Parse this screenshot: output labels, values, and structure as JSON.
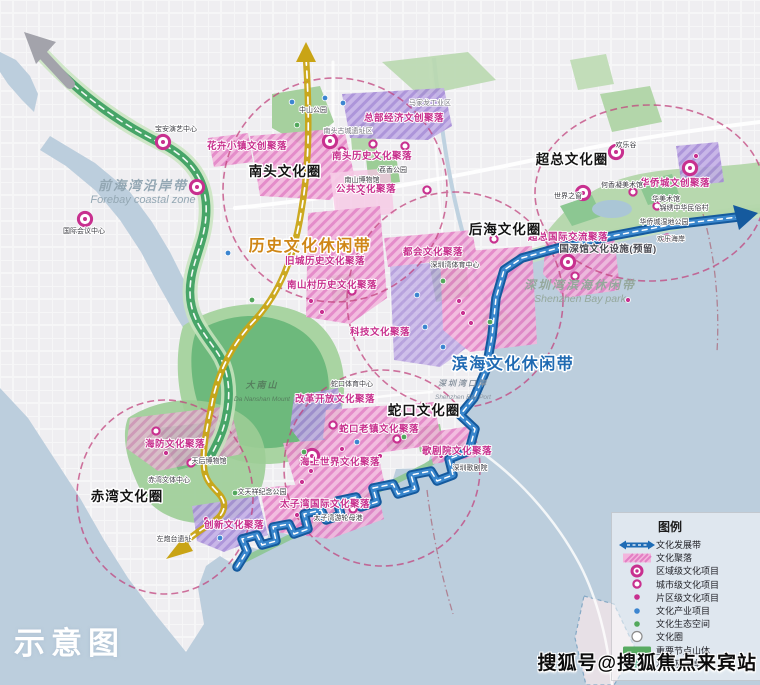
{
  "stamp": "示意图",
  "watermark": "搜狐号@搜狐焦点来宾站",
  "colors": {
    "sea": "#bccedd",
    "land": "#efeef1",
    "corridor_green": "#47a568",
    "route_yellow": "#c9a415",
    "route_blue": "#155a9e",
    "circle_dash": "#c2447e",
    "cluster_pink": "#e37fc4",
    "cluster_purple": "#a489d6",
    "marker_magenta": "#c8308f",
    "marker_blue": "#3c85d0",
    "marker_green": "#52a85c",
    "belt_gold_text": "#cf8616",
    "belt_blue_text": "#1f6ab2"
  },
  "legend": {
    "title": "图例",
    "items": [
      {
        "icon": "development-belt",
        "label": "文化发展带"
      },
      {
        "icon": "cluster-swatch",
        "label": "文化聚落"
      },
      {
        "icon": "regional-project",
        "label": "区域级文化项目"
      },
      {
        "icon": "city-project",
        "label": "城市级文化项目"
      },
      {
        "icon": "district-project",
        "label": "片区级文化项目"
      },
      {
        "icon": "industry-project",
        "label": "文化产业项目"
      },
      {
        "icon": "eco-space",
        "label": "文化生态空间"
      },
      {
        "icon": "culture-circle",
        "label": "文化圈"
      },
      {
        "icon": "mountain-node",
        "label": "重要节点山体"
      },
      {
        "icon": "water-coast",
        "label": "水系及海岸带"
      }
    ]
  },
  "labels": {
    "belts": [
      {
        "t": "历史文化休闲带",
        "x": 310,
        "y": 251,
        "size": 16,
        "color": "#cf8616"
      },
      {
        "t": "滨海文化休闲带",
        "x": 513,
        "y": 369,
        "size": 16,
        "color": "#1f6ab2"
      }
    ],
    "circles": [
      {
        "t": "南头文化圈",
        "x": 285,
        "y": 176
      },
      {
        "t": "超总文化圈",
        "x": 572,
        "y": 164
      },
      {
        "t": "后海文化圈",
        "x": 505,
        "y": 234
      },
      {
        "t": "蛇口文化圈",
        "x": 424,
        "y": 415
      },
      {
        "t": "赤湾文化圈",
        "x": 127,
        "y": 501
      }
    ],
    "clusters": [
      {
        "t": "总部经济文创聚落",
        "x": 404,
        "y": 121
      },
      {
        "t": "花卉小镇文创聚落",
        "x": 247,
        "y": 149
      },
      {
        "t": "南头历史文化聚落",
        "x": 372,
        "y": 159
      },
      {
        "t": "公共文化聚落",
        "x": 366,
        "y": 192
      },
      {
        "t": "旧城历史文化聚落",
        "x": 325,
        "y": 264
      },
      {
        "t": "南山村历史文化聚落",
        "x": 332,
        "y": 288
      },
      {
        "t": "都会文化聚落",
        "x": 433,
        "y": 255
      },
      {
        "t": "科技文化聚落",
        "x": 380,
        "y": 335
      },
      {
        "t": "华侨城文创聚落",
        "x": 675,
        "y": 186
      },
      {
        "t": "超总国际交流聚落",
        "x": 568,
        "y": 240
      },
      {
        "t": "国深馆文化设施(预留)",
        "x": 608,
        "y": 252,
        "color": "#4a4a52"
      },
      {
        "t": "改革开放文化聚落",
        "x": 335,
        "y": 402
      },
      {
        "t": "蛇口老镇文化聚落",
        "x": 379,
        "y": 432
      },
      {
        "t": "海上世界文化聚落",
        "x": 340,
        "y": 465
      },
      {
        "t": "太子湾国际文化聚落",
        "x": 325,
        "y": 507
      },
      {
        "t": "歌剧院文化聚落",
        "x": 457,
        "y": 454
      },
      {
        "t": "创新文化聚落",
        "x": 234,
        "y": 528
      },
      {
        "t": "海防文化聚落",
        "x": 175,
        "y": 447
      }
    ],
    "areas": [
      {
        "t": "前海湾沿岸带",
        "sub": "Forebay coastal zone",
        "x": 143,
        "y": 190,
        "size": 13,
        "subsize": 11,
        "color": "#93a7b3"
      },
      {
        "t": "深圳湾滨海休闲带",
        "sub": "Shenzhen Bay park",
        "x": 580,
        "y": 289,
        "size": 12,
        "subsize": 10.5,
        "color": "#95a89c"
      },
      {
        "t": "大南山",
        "sub": "Da Nanshan Mount",
        "x": 262,
        "y": 388,
        "size": 9,
        "subsize": 6.5,
        "color": "#567f5e"
      },
      {
        "t": "深圳湾口岸",
        "sub": "Shenzhen Bay Port",
        "x": 463,
        "y": 386,
        "size": 8,
        "subsize": 6.5,
        "color": "#8b96a2"
      }
    ],
    "places": [
      {
        "t": "宝安演艺中心",
        "x": 176,
        "y": 131
      },
      {
        "t": "国际会议中心",
        "x": 84,
        "y": 233
      },
      {
        "t": "中山公园",
        "x": 313,
        "y": 112
      },
      {
        "t": "南头古城遗址区",
        "x": 348,
        "y": 133,
        "gray": true
      },
      {
        "t": "马家龙工业区",
        "x": 430,
        "y": 105,
        "gray": true
      },
      {
        "t": "荔香公园",
        "x": 393,
        "y": 172
      },
      {
        "t": "南山博物馆",
        "x": 362,
        "y": 182
      },
      {
        "t": "深圳湾体育中心",
        "x": 455,
        "y": 267
      },
      {
        "t": "欢乐谷",
        "x": 626,
        "y": 147
      },
      {
        "t": "世界之窗",
        "x": 568,
        "y": 198
      },
      {
        "t": "何香凝美术馆",
        "x": 622,
        "y": 187
      },
      {
        "t": "华美术馆",
        "x": 666,
        "y": 201
      },
      {
        "t": "锦绣中华民俗村",
        "x": 684,
        "y": 210
      },
      {
        "t": "华侨城湿地公园",
        "x": 664,
        "y": 224
      },
      {
        "t": "欢乐海岸",
        "x": 671,
        "y": 241
      },
      {
        "t": "蛇口体育中心",
        "x": 352,
        "y": 386
      },
      {
        "t": "深圳歌剧院",
        "x": 470,
        "y": 470
      },
      {
        "t": "太子湾游轮母港",
        "x": 338,
        "y": 520
      },
      {
        "t": "文天祥纪念公园",
        "x": 262,
        "y": 494
      },
      {
        "t": "天后博物馆",
        "x": 209,
        "y": 463
      },
      {
        "t": "赤湾文体中心",
        "x": 169,
        "y": 482
      },
      {
        "t": "左炮台遗址",
        "x": 174,
        "y": 541
      }
    ]
  },
  "markers": {
    "regional": [
      [
        85,
        219
      ],
      [
        163,
        142
      ],
      [
        197,
        187
      ],
      [
        330,
        141
      ],
      [
        616,
        152
      ],
      [
        690,
        168
      ],
      [
        583,
        193
      ],
      [
        568,
        262
      ],
      [
        312,
        456
      ]
    ],
    "city": [
      [
        342,
        151
      ],
      [
        373,
        144
      ],
      [
        405,
        146
      ],
      [
        633,
        192
      ],
      [
        657,
        206
      ],
      [
        494,
        239
      ],
      [
        427,
        190
      ],
      [
        352,
        291
      ],
      [
        333,
        425
      ],
      [
        397,
        439
      ],
      [
        156,
        431
      ],
      [
        191,
        463
      ],
      [
        353,
        509
      ],
      [
        575,
        276
      ],
      [
        667,
        238
      ],
      [
        437,
        411
      ]
    ],
    "district": [
      [
        351,
        183
      ],
      [
        363,
        193
      ],
      [
        449,
        249
      ],
      [
        459,
        301
      ],
      [
        463,
        313
      ],
      [
        471,
        323
      ],
      [
        311,
        301
      ],
      [
        322,
        312
      ],
      [
        342,
        449
      ],
      [
        311,
        471
      ],
      [
        302,
        482
      ],
      [
        166,
        453
      ],
      [
        206,
        519
      ],
      [
        441,
        456
      ],
      [
        696,
        156
      ],
      [
        628,
        300
      ],
      [
        380,
        456
      ],
      [
        297,
        515
      ]
    ],
    "industry": [
      [
        325,
        98
      ],
      [
        343,
        103
      ],
      [
        292,
        102
      ],
      [
        228,
        253
      ],
      [
        417,
        295
      ],
      [
        425,
        327
      ],
      [
        443,
        347
      ],
      [
        688,
        182
      ],
      [
        357,
        442
      ],
      [
        220,
        538
      ]
    ],
    "eco": [
      [
        297,
        125
      ],
      [
        380,
        170
      ],
      [
        443,
        281
      ],
      [
        645,
        221
      ],
      [
        490,
        322
      ],
      [
        235,
        493
      ],
      [
        404,
        437
      ],
      [
        304,
        452
      ],
      [
        252,
        300
      ]
    ]
  }
}
